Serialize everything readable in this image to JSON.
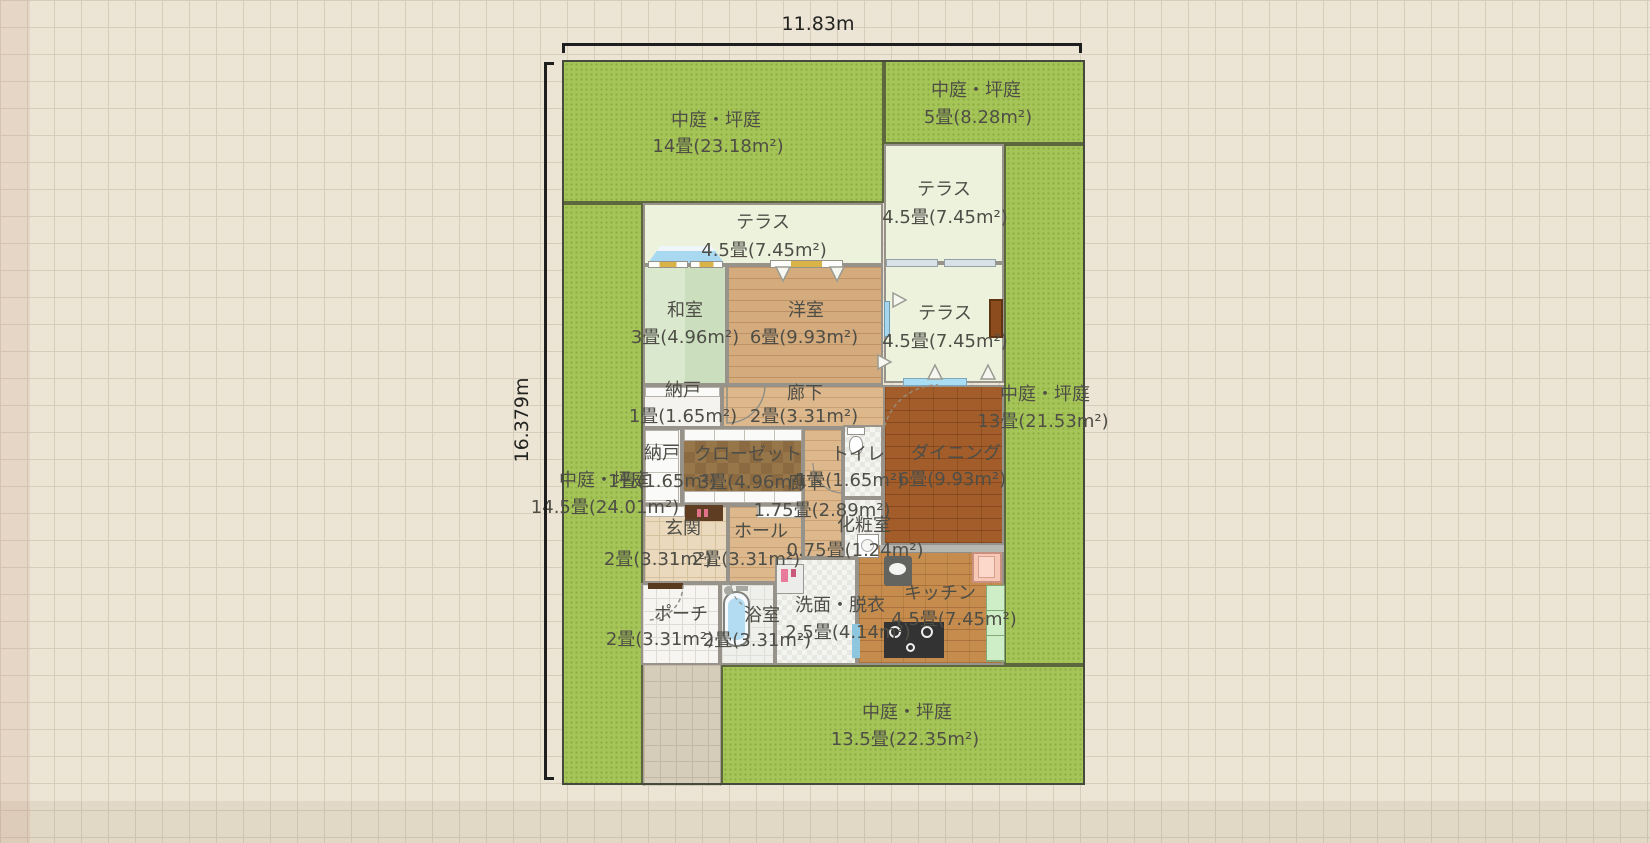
{
  "app": "floor-plan-canvas",
  "dimensions": {
    "width_label": "11.83m",
    "height_label": "16.379m"
  },
  "areas": {
    "garden_top": {
      "name": "中庭・坪庭",
      "size": "14畳(23.18m²)"
    },
    "garden_top_right": {
      "name": "中庭・坪庭",
      "size": "5畳(8.28m²)"
    },
    "garden_left": {
      "name": "中庭・坪庭",
      "size": "14.5畳(24.01m²)"
    },
    "garden_right": {
      "name": "中庭・坪庭",
      "size": "13畳(21.53m²)"
    },
    "garden_bottom": {
      "name": "中庭・坪庭",
      "size": "13.5畳(22.35m²)"
    },
    "terrace_top": {
      "name": "テラス",
      "size": "4.5畳(7.45m²)"
    },
    "terrace_right_upper": {
      "name": "テラス",
      "size": "4.5畳(7.45m²)"
    },
    "terrace_right_lower": {
      "name": "テラス",
      "size": "4.5畳(7.45m²)"
    },
    "washitsu": {
      "name": "和室",
      "size": "3畳(4.96m²)"
    },
    "youshitsu": {
      "name": "洋室",
      "size": "6畳(9.93m²)"
    },
    "nando_upper": {
      "name": "納戸",
      "size": "1畳(1.65m²)"
    },
    "rouka_upper": {
      "name": "廊下",
      "size": "2畳(3.31m²)"
    },
    "nando_lower": {
      "name": "納戸",
      "size": "1畳(1.65m²)"
    },
    "closet": {
      "name": "クローゼット",
      "size": "3畳(4.96m²)"
    },
    "toilet": {
      "name": "トイレ",
      "size": "1畳(1.65m²)"
    },
    "dining": {
      "name": "ダイニング",
      "size": "6畳(9.93m²)"
    },
    "rouka_lower": {
      "name": "廊下",
      "size": "1.75畳(2.89m²)"
    },
    "genkan": {
      "name": "玄関",
      "size": "2畳(3.31m²)"
    },
    "hall": {
      "name": "ホール",
      "size": "2畳(3.31m²)"
    },
    "keshoshitsu": {
      "name": "化粧室",
      "size": "0.75畳(1.24m²)"
    },
    "porch": {
      "name": "ポーチ",
      "size": "2畳(3.31m²)"
    },
    "bathroom": {
      "name": "浴室",
      "size": "2畳(3.31m²)"
    },
    "senmen": {
      "name": "洗面・脱衣",
      "size": "2.5畳(4.14m²)"
    },
    "kitchen": {
      "name": "キッチン",
      "size": "4.5畳(7.45m²)"
    }
  },
  "fixtures": [
    "bathtub",
    "toilet",
    "washing-machine",
    "refrigerator",
    "gas-stove",
    "kitchen-sink",
    "kitchen-cabinet",
    "entrance-step",
    "shoe-cabinet",
    "closet-shelf",
    "door",
    "window",
    "bay-window",
    "door-swing-arc"
  ],
  "colors": {
    "background": "#ece4d4",
    "grid_line": "#d7cdbb",
    "garden": "#a6c558",
    "terrace": "#edf2dd",
    "tatami": "#d2e2c6",
    "wood": "#d4ab7d",
    "dining_brick": "#a25d2b",
    "kitchen_brick": "#c68c4d",
    "closet_brown": "#97764a",
    "label_text": "#4e4e47",
    "dimension_text": "#22221f",
    "wall": "#97938b"
  }
}
